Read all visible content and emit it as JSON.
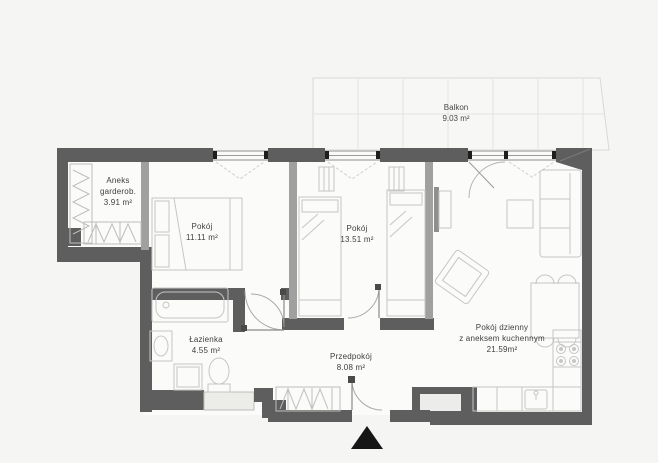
{
  "plan_type": "apartment-floor-plan",
  "rooms": {
    "balkon": {
      "name": "Balkon",
      "area": "9.03 m²"
    },
    "aneks": {
      "name": "Aneks",
      "name2": "garderob.",
      "area": "3.91 m²"
    },
    "pokoj1": {
      "name": "Pokój",
      "area": "11.11 m²"
    },
    "pokoj2": {
      "name": "Pokój",
      "area": "13.51 m²"
    },
    "lazienka": {
      "name": "Łazienka",
      "area": "4.55 m²"
    },
    "przedpokoj": {
      "name": "Przedpokój",
      "area": "8.08 m²"
    },
    "dzienny": {
      "name": "Pokój dzienny",
      "name2": "z aneksem kuchennym",
      "area": "21.59m²"
    }
  },
  "colors": {
    "background": "#f5f5f3",
    "floor": "#fbfbf9",
    "exterior_wall": "#5e5e5e",
    "partition_wall": "#a0a0a0",
    "furniture_line": "#c6c6c4",
    "door_arc": "#a9a9a7",
    "balcony_grid": "#e3e3e1",
    "label_text": "#3e3e3e",
    "entrance_marker": "#161616"
  },
  "furniture": [
    "double-bed",
    "single-bed",
    "single-bed",
    "nightstand",
    "nightstand",
    "bathtub",
    "washbasin",
    "washing-machine",
    "toilet",
    "wardrobe",
    "wardrobe",
    "hall-wardrobe",
    "tv",
    "tv-cabinet",
    "sofa",
    "coffee-table",
    "armchair",
    "dining-table",
    "dining-chairs",
    "kitchen-counter",
    "kitchen-sink",
    "stove",
    "shaft"
  ]
}
